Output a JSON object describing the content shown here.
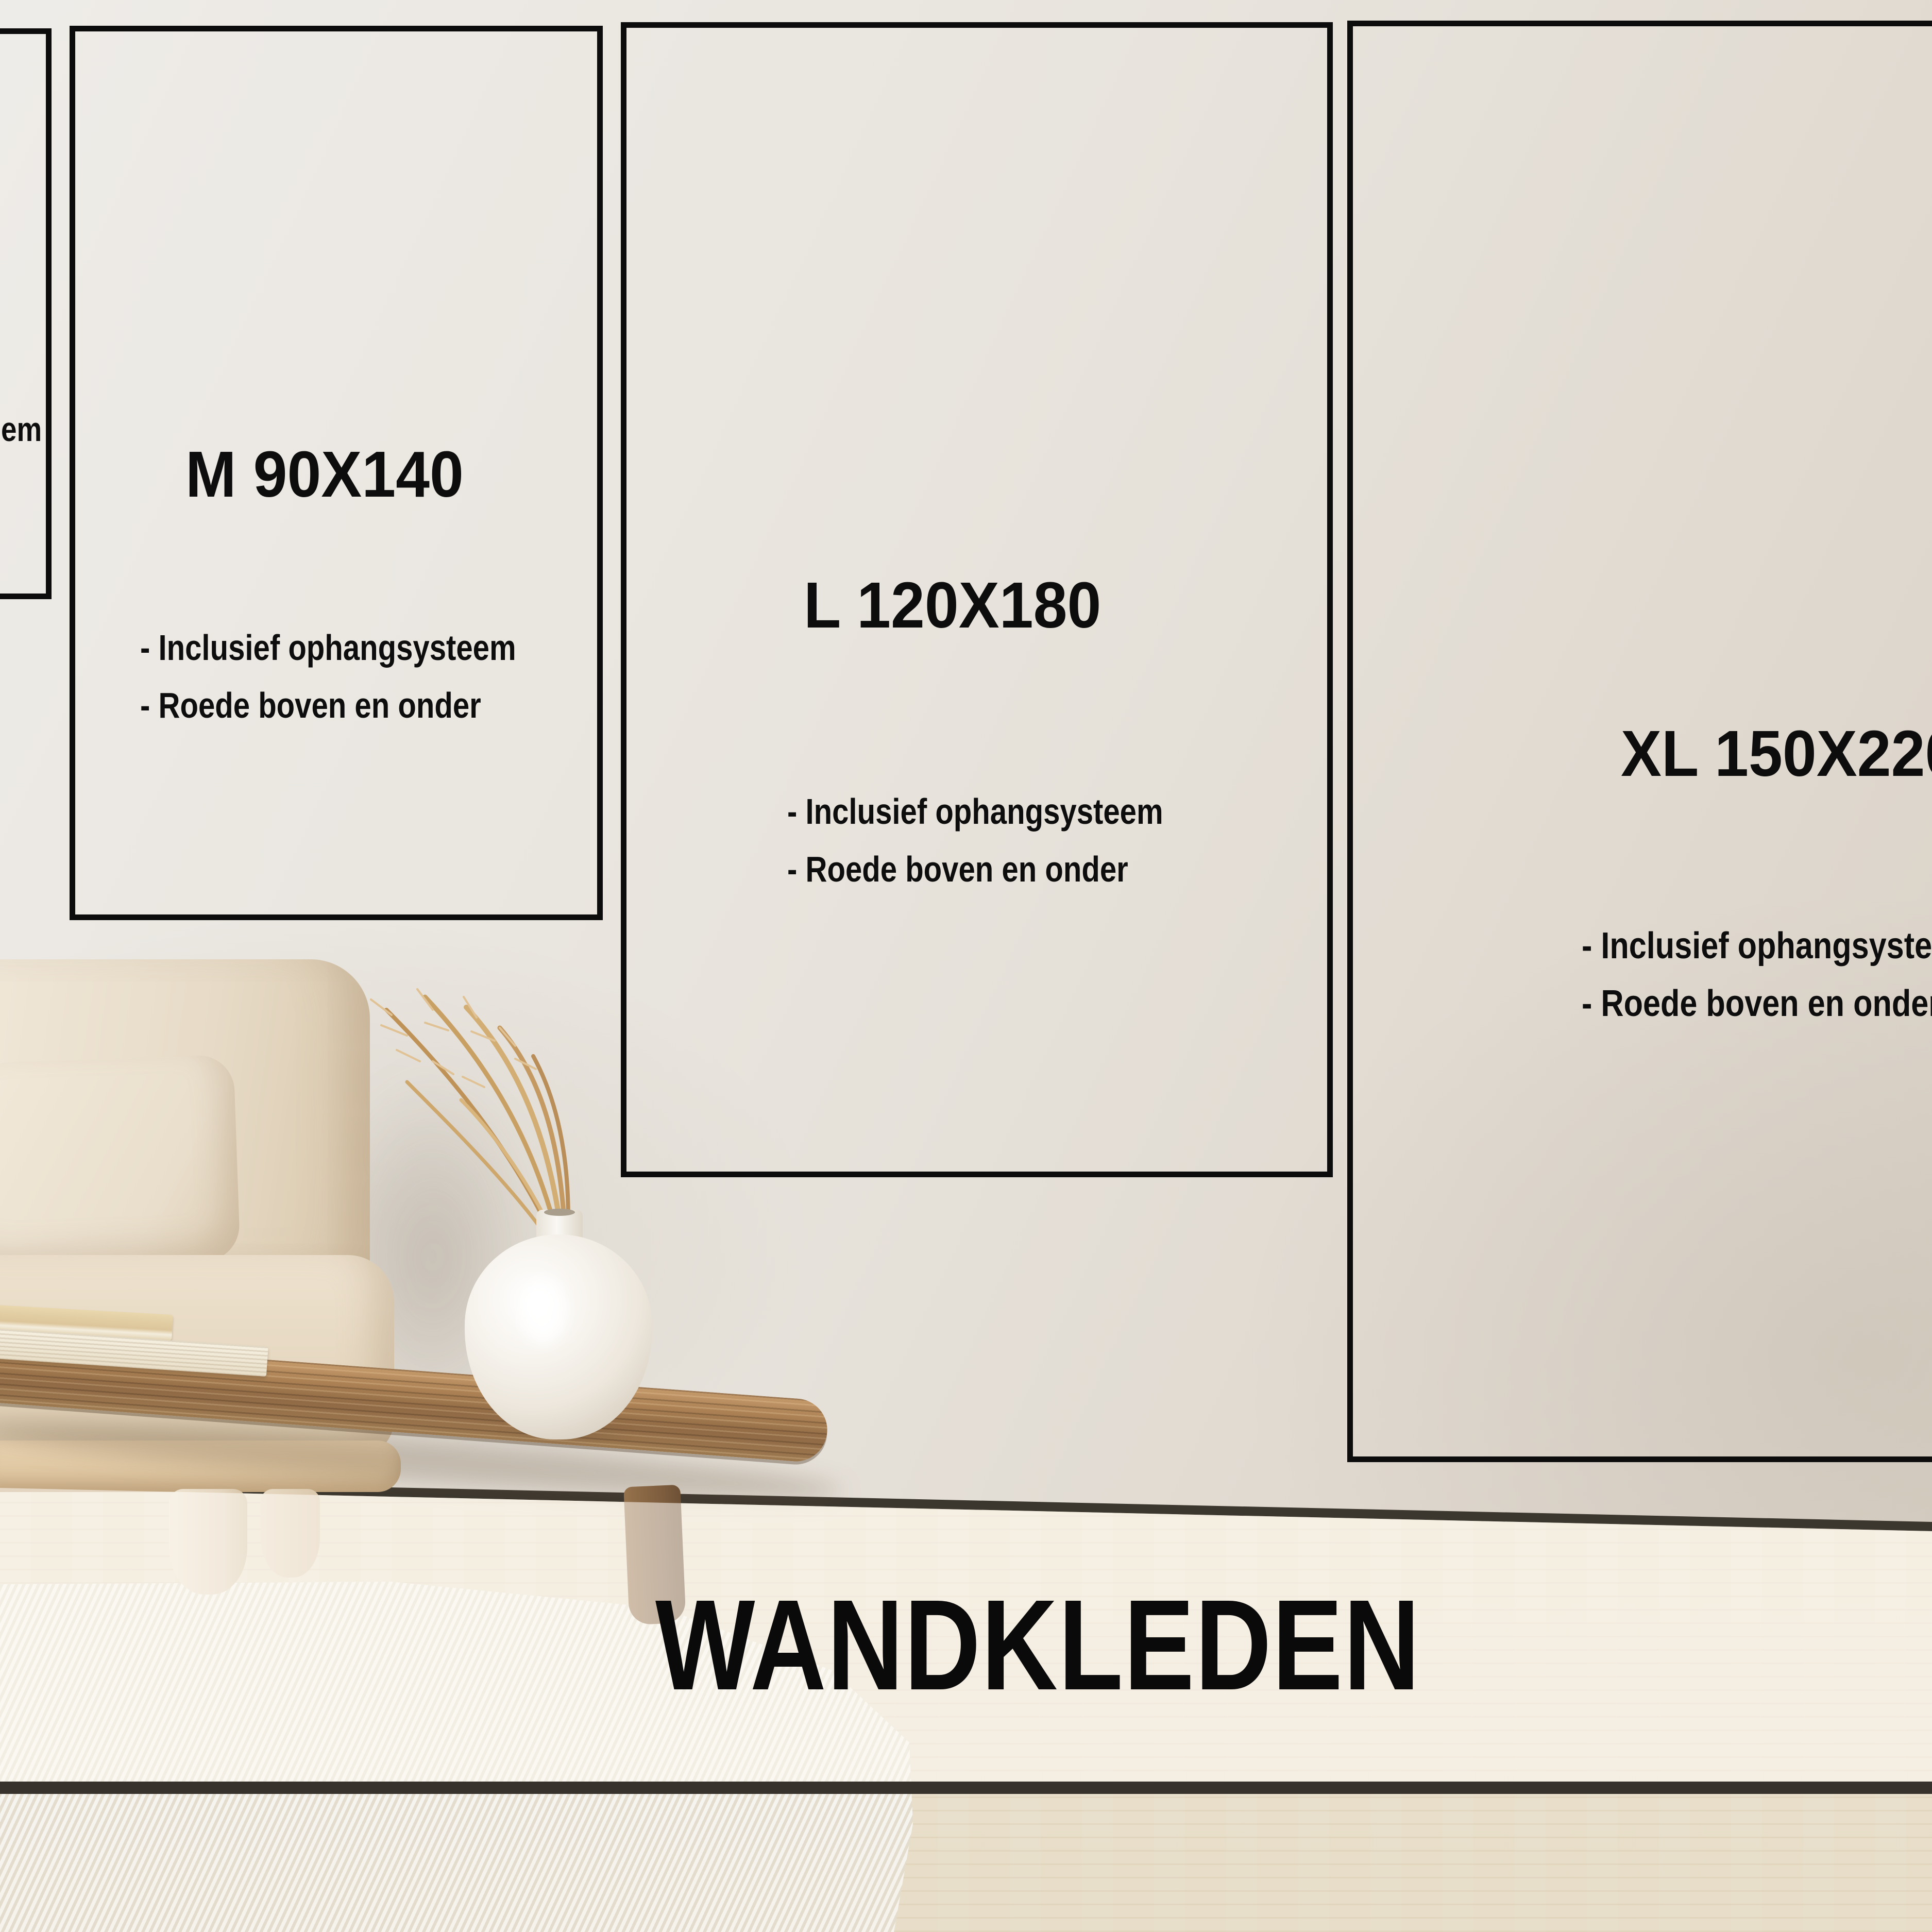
{
  "banner": {
    "label": "WANDKLEDEN"
  },
  "sizes": {
    "s": {
      "fragment": "em"
    },
    "m": {
      "title": "M 90X140",
      "features": [
        "- Inclusief ophangsysteem",
        "- Roede boven en onder"
      ]
    },
    "l": {
      "title": "L 120X180",
      "features": [
        "- Inclusief ophangsysteem",
        "- Roede boven en onder"
      ]
    },
    "xl": {
      "title": "XL 150X220",
      "features": [
        "- Inclusief ophangsysteem",
        "- Roede boven en onder"
      ]
    }
  },
  "colors": {
    "outline": "#0c0c0c",
    "text": "#0d0d0d",
    "wall": "#e6e1da",
    "floor": "#e9dfcb",
    "band": "rgba(255,252,246,0.55)",
    "band_line": "#37322b",
    "baseboard_line": "#3b362e",
    "wood": "#a67d52",
    "sofa": "#e8dcc8",
    "vase": "#f4f1ec",
    "grass": "#c49a62",
    "rug": "#f2eee6"
  }
}
